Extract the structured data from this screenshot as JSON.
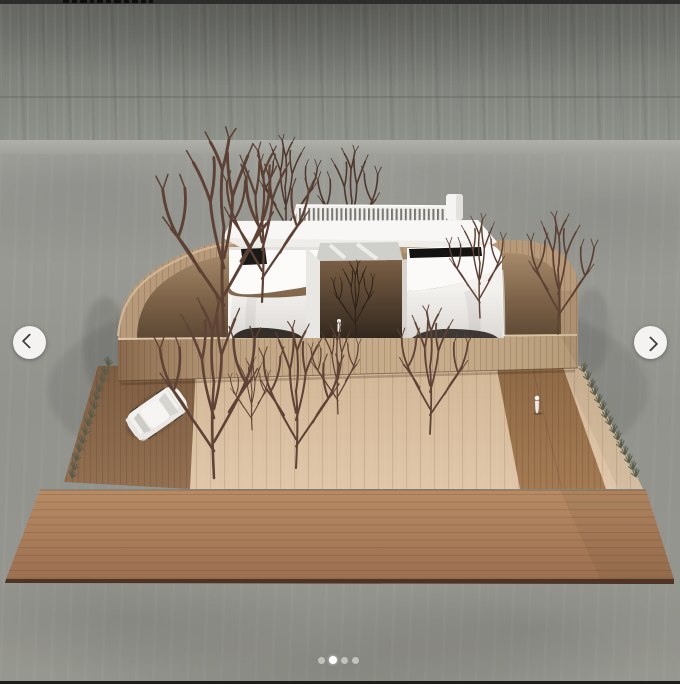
{
  "carousel": {
    "prev_button": {
      "icon": "chevron-left-icon"
    },
    "next_button": {
      "icon": "chevron-right-icon"
    },
    "dots": {
      "count": 4,
      "active_index": 1
    }
  },
  "image": {
    "description": "3D architectural scale-model render: white curved modern house with slatted roof and central glass atrium, surrounded by a rounded wooden fence, bare winter trees, a white car on a wooden driveway, a walking figure on a wooden path, wide wooden deck in the foreground, all on a concrete backdrop",
    "elements": [
      "building-model",
      "wooden-fence",
      "bare-trees",
      "white-car",
      "human-figure",
      "wood-deck",
      "concrete-wall",
      "concrete-floor"
    ]
  },
  "top_strip": {
    "note": "cropped dark edge with partial text glyph remnants"
  },
  "bottom_strip": {
    "note": "cropped dark edge"
  },
  "palette": {
    "top_bar": "#2d2d2b",
    "bottom_bar": "#1c1c1b",
    "nav_button_bg": "#f4f3f1",
    "nav_chevron": "#3e3e3e",
    "dot_active": "#ffffff",
    "dot_inactive": "rgba(243,242,240,0.55)",
    "concrete_wall": "#7d7f79",
    "concrete_floor": "#94958f",
    "fence_wood": "#c2a787",
    "deck_wood": "#aa7d59",
    "light_wood": "#d8bfa2",
    "building_white": "#f6f5f3",
    "window_slot": "#151514",
    "tree_brown": "#5c4134"
  }
}
